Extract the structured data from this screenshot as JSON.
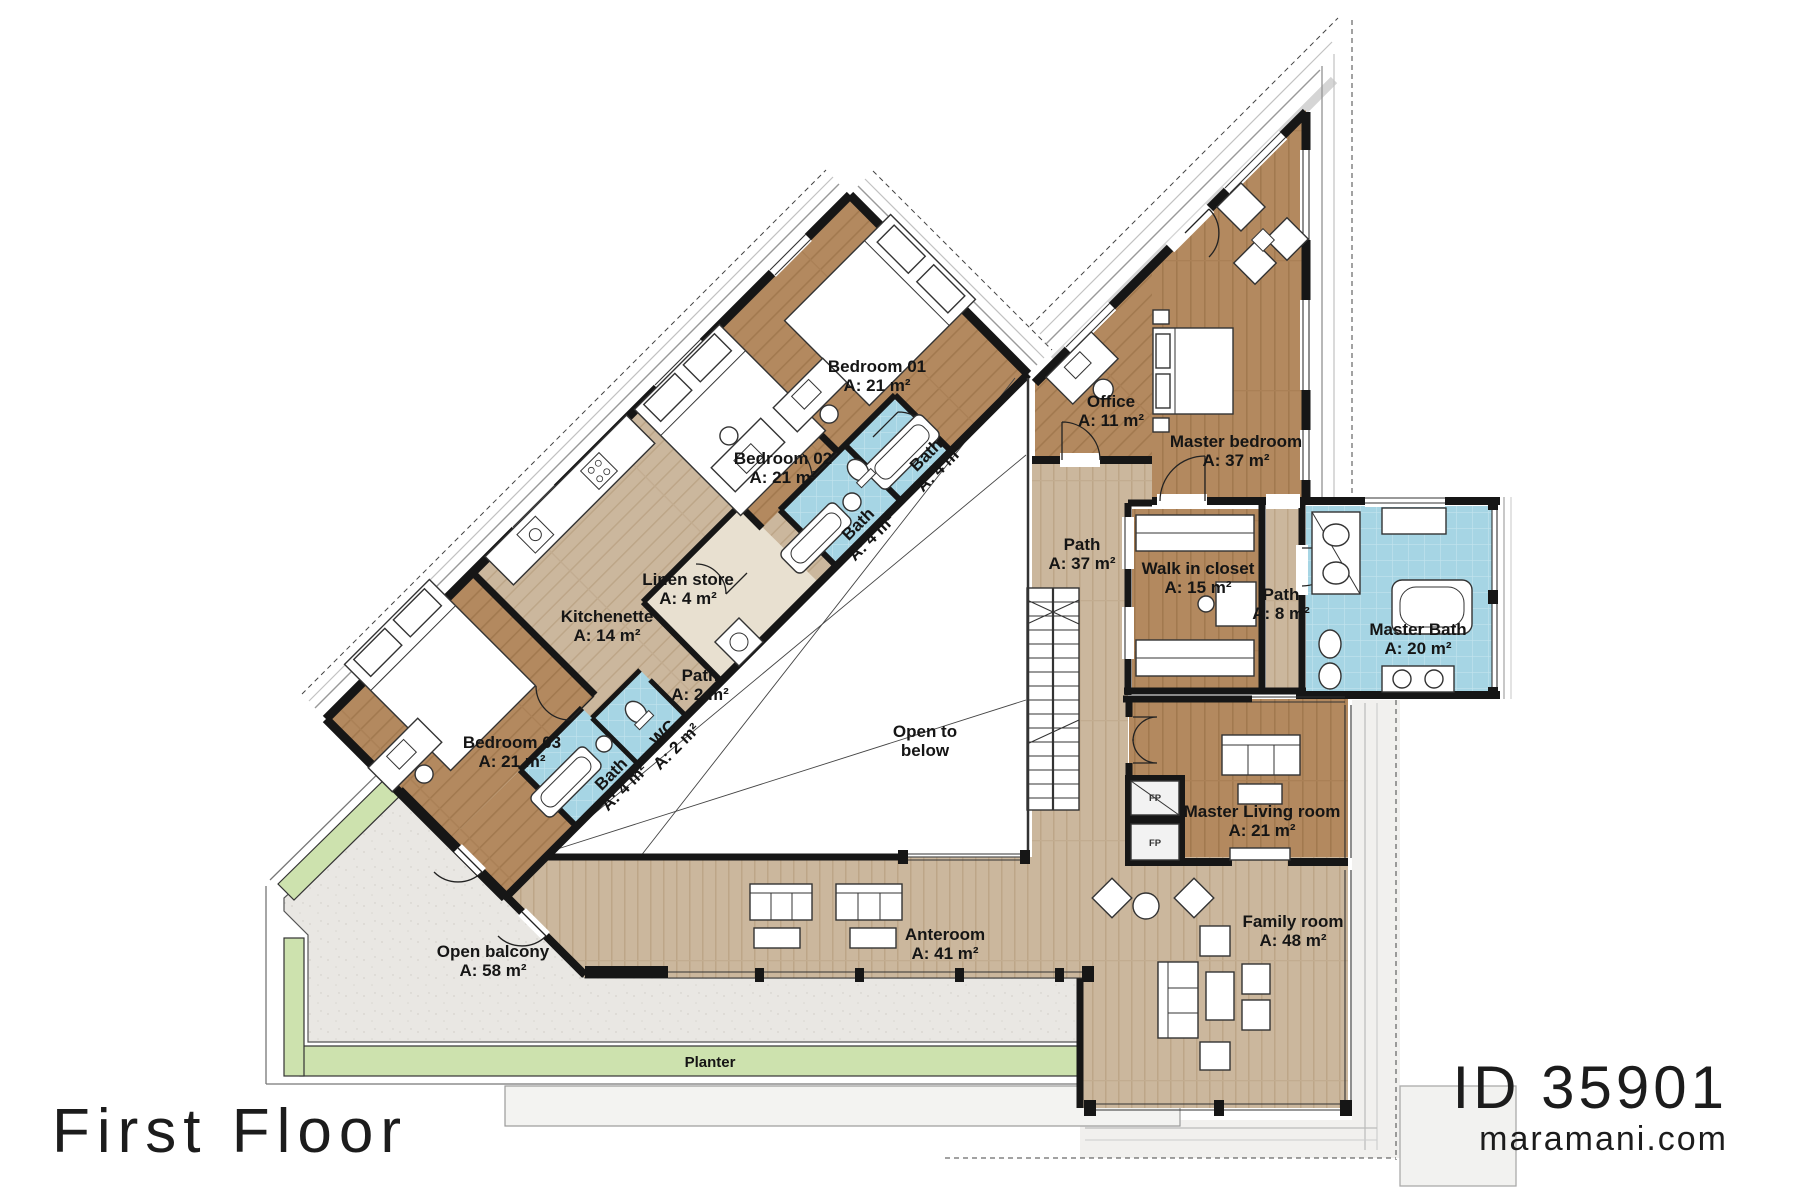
{
  "meta": {
    "floor_title": "First Floor",
    "plan_id": "ID 35901",
    "website": "maramani.com"
  },
  "colors": {
    "wood_dark": "#b3895f",
    "wood_light": "#cbb79d",
    "tile_blue": "#a6d5e4",
    "planter_green": "#cde2ae",
    "concrete": "#e9e7e3",
    "wall": "#161616",
    "linen_beige": "#e8e0d0"
  },
  "rooms": [
    {
      "id": "bedroom-01",
      "lines": [
        "Bedroom 01",
        "A: 21 m²"
      ],
      "x": 877,
      "y": 372,
      "rot": 0,
      "cls": "room-label"
    },
    {
      "id": "bath-01",
      "lines": [
        "Bath",
        "A: 4 m²"
      ],
      "x": 930,
      "y": 459,
      "rot": -45,
      "cls": "room-label"
    },
    {
      "id": "bath-02",
      "lines": [
        "Bath",
        "A: 4 m²"
      ],
      "x": 862,
      "y": 528,
      "rot": -45,
      "cls": "room-label"
    },
    {
      "id": "bedroom-02",
      "lines": [
        "Bedroom 02",
        "A: 21 m²"
      ],
      "x": 783,
      "y": 464,
      "rot": 0,
      "cls": "room-label"
    },
    {
      "id": "linen-store",
      "lines": [
        "Linen store",
        "A: 4 m²"
      ],
      "x": 688,
      "y": 585,
      "rot": 0,
      "cls": "room-label"
    },
    {
      "id": "kitchenette",
      "lines": [
        "Kitchenette",
        "A: 14 m²"
      ],
      "x": 607,
      "y": 622,
      "rot": 0,
      "cls": "room-label"
    },
    {
      "id": "path-2",
      "lines": [
        "Path",
        "A: 2 m²"
      ],
      "x": 700,
      "y": 681,
      "rot": 0,
      "cls": "room-label"
    },
    {
      "id": "wc",
      "lines": [
        "WC",
        "A: 2 m²"
      ],
      "x": 667,
      "y": 737,
      "rot": -45,
      "cls": "room-label"
    },
    {
      "id": "bath-03",
      "lines": [
        "Bath",
        "A: 4 m²"
      ],
      "x": 615,
      "y": 778,
      "rot": -45,
      "cls": "room-label"
    },
    {
      "id": "bedroom-03",
      "lines": [
        "Bedroom 03",
        "A: 21 m²"
      ],
      "x": 512,
      "y": 748,
      "rot": 0,
      "cls": "room-label"
    },
    {
      "id": "office",
      "lines": [
        "Office",
        "A: 11 m²"
      ],
      "x": 1111,
      "y": 407,
      "rot": 0,
      "cls": "room-label"
    },
    {
      "id": "master-bedroom",
      "lines": [
        "Master bedroom",
        "A: 37 m²"
      ],
      "x": 1236,
      "y": 447,
      "rot": 0,
      "cls": "room-label"
    },
    {
      "id": "path-37",
      "lines": [
        "Path",
        "A: 37 m²"
      ],
      "x": 1082,
      "y": 550,
      "rot": 0,
      "cls": "room-label"
    },
    {
      "id": "walk-in-closet",
      "lines": [
        "Walk in closet",
        "A: 15 m²"
      ],
      "x": 1198,
      "y": 574,
      "rot": 0,
      "cls": "room-label"
    },
    {
      "id": "path-8",
      "lines": [
        "Path",
        "A: 8 m²"
      ],
      "x": 1281,
      "y": 600,
      "rot": 0,
      "cls": "room-label"
    },
    {
      "id": "master-bath",
      "lines": [
        "Master Bath",
        "A: 20 m²"
      ],
      "x": 1418,
      "y": 635,
      "rot": 0,
      "cls": "room-label"
    },
    {
      "id": "open-to-below",
      "lines": [
        "Open to",
        "below"
      ],
      "x": 925,
      "y": 737,
      "rot": 0,
      "cls": "room-label"
    },
    {
      "id": "master-living-room",
      "lines": [
        "Master Living room",
        "A: 21 m²"
      ],
      "x": 1262,
      "y": 817,
      "rot": 0,
      "cls": "room-label"
    },
    {
      "id": "anteroom",
      "lines": [
        "Anteroom",
        "A: 41 m²"
      ],
      "x": 945,
      "y": 940,
      "rot": 0,
      "cls": "room-label"
    },
    {
      "id": "family-room",
      "lines": [
        "Family room",
        "A: 48 m²"
      ],
      "x": 1293,
      "y": 927,
      "rot": 0,
      "cls": "room-label"
    },
    {
      "id": "open-balcony",
      "lines": [
        "Open balcony",
        "A: 58 m²"
      ],
      "x": 493,
      "y": 957,
      "rot": 0,
      "cls": "room-label"
    },
    {
      "id": "planter",
      "lines": [
        "Planter"
      ],
      "x": 710,
      "y": 1067,
      "rot": 0,
      "cls": "planter-label"
    },
    {
      "id": "fp-upper",
      "lines": [
        "FP"
      ],
      "x": 1155,
      "y": 801,
      "rot": 0,
      "cls": "tiny-label"
    },
    {
      "id": "fp-lower",
      "lines": [
        "FP"
      ],
      "x": 1155,
      "y": 846,
      "rot": 0,
      "cls": "tiny-label"
    }
  ]
}
